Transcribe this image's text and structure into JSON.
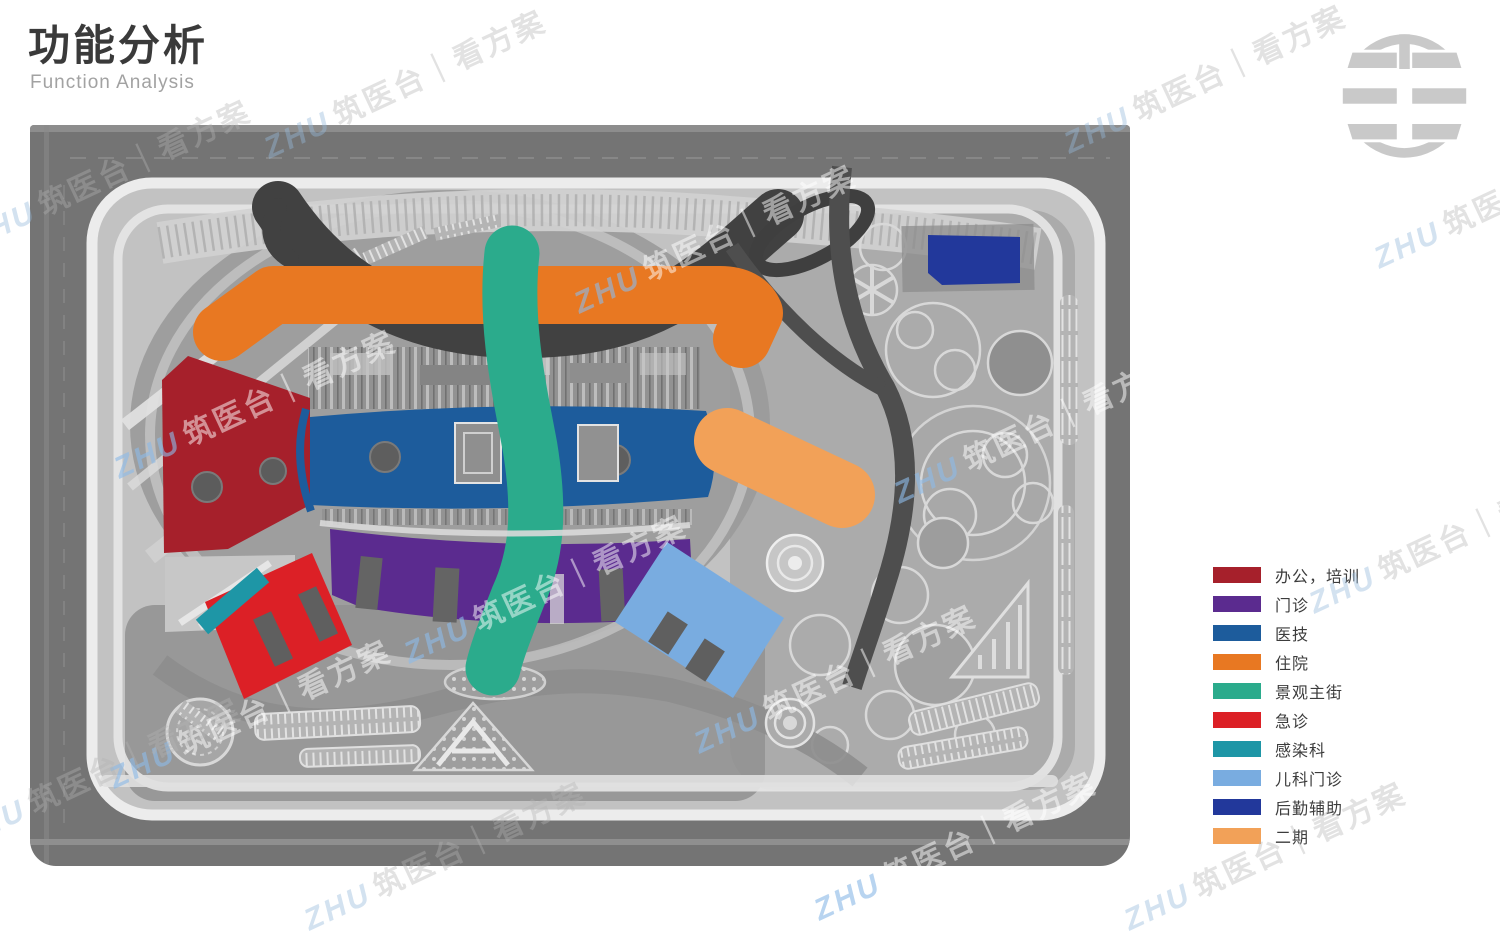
{
  "slide": {
    "title": "功能分析",
    "subtitle": "Function Analysis"
  },
  "watermark": {
    "brand": "ZHU",
    "text": "筑医台｜看方案"
  },
  "legend": {
    "items": [
      {
        "label": "办公，培训",
        "color": "#A6202B"
      },
      {
        "label": "门诊",
        "color": "#5B2B8F"
      },
      {
        "label": "医技",
        "color": "#1D5C9C"
      },
      {
        "label": "住院",
        "color": "#E87822"
      },
      {
        "label": "景观主街",
        "color": "#2BAB8C"
      },
      {
        "label": "急诊",
        "color": "#DC2026"
      },
      {
        "label": "感染科",
        "color": "#1E96A6"
      },
      {
        "label": "儿科门诊",
        "color": "#79ACE0"
      },
      {
        "label": "后勤辅助",
        "color": "#22389B"
      },
      {
        "label": "二期",
        "color": "#F2A158"
      }
    ]
  },
  "plan": {
    "zones": [
      {
        "name": "office-training",
        "legend": "办公，培训"
      },
      {
        "name": "outpatient",
        "legend": "门诊"
      },
      {
        "name": "medical-tech",
        "legend": "医技"
      },
      {
        "name": "inpatient",
        "legend": "住院"
      },
      {
        "name": "landscape-main-street",
        "legend": "景观主街"
      },
      {
        "name": "emergency",
        "legend": "急诊"
      },
      {
        "name": "infection-dept",
        "legend": "感染科"
      },
      {
        "name": "pediatric-outpatient",
        "legend": "儿科门诊"
      },
      {
        "name": "logistics-support",
        "legend": "后勤辅助"
      },
      {
        "name": "phase-two",
        "legend": "二期"
      }
    ]
  }
}
